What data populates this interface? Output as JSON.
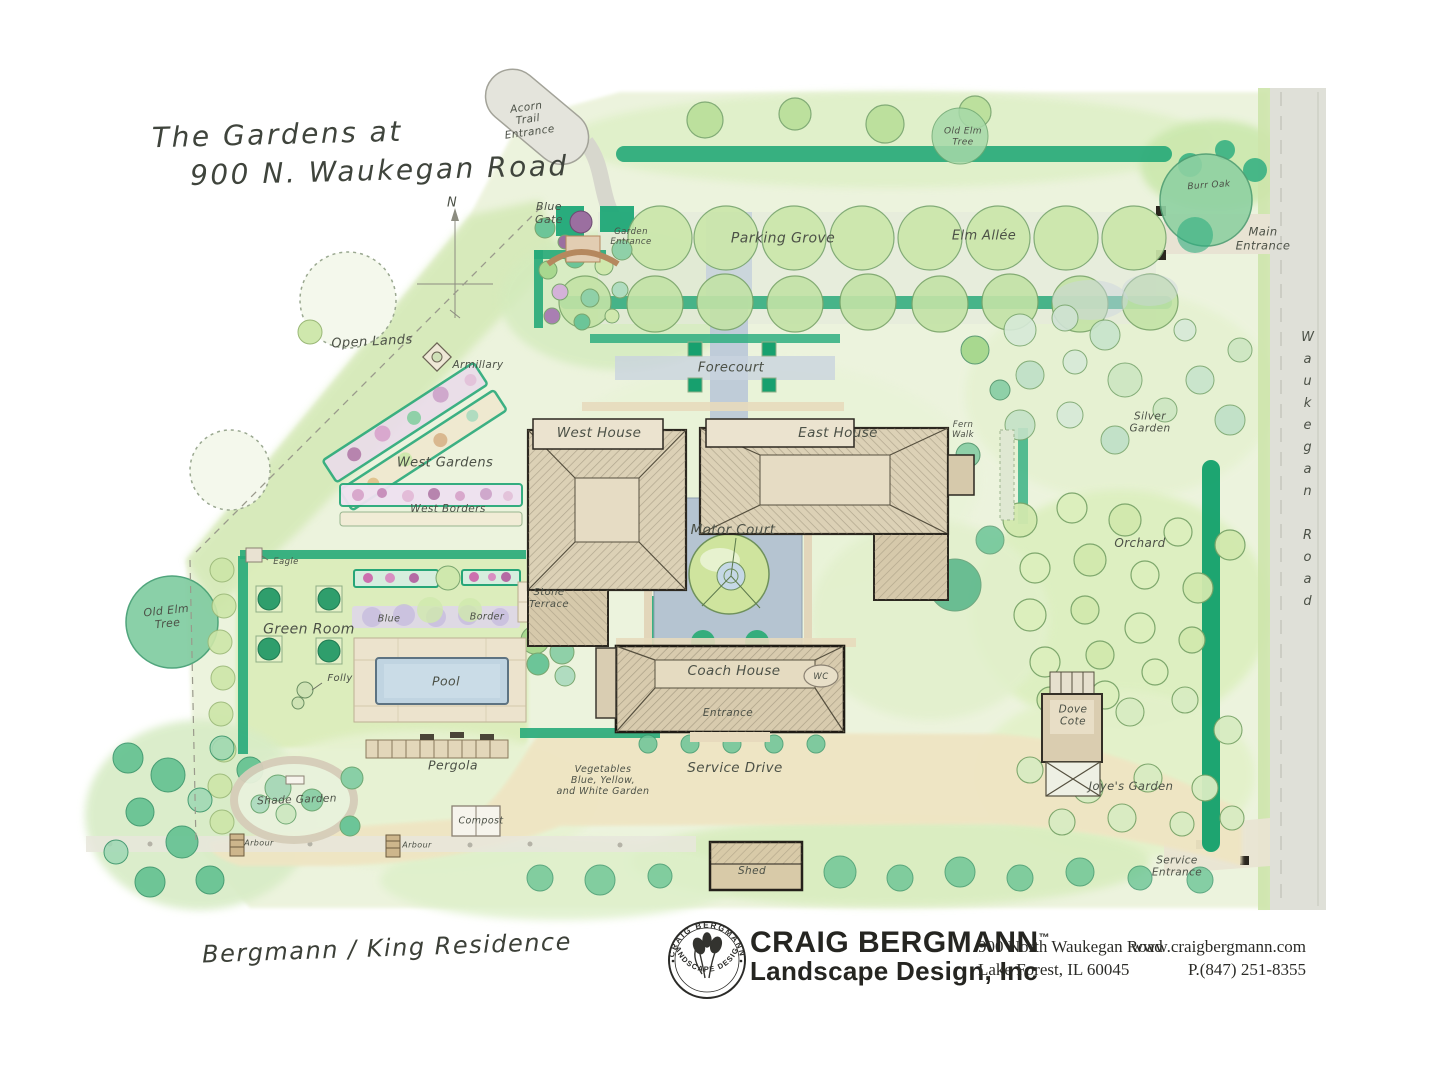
{
  "palette": {
    "paper": "#ffffff",
    "wash_light": "#ecf3dc",
    "wash_mid": "#d7ebc0",
    "hedge_teal": "#1ca273",
    "tree_green": "#cde8ad",
    "building_tan": "#dcd1b6",
    "path_beige": "#ece2c6",
    "court_blue": "#b4c3cf",
    "pool_blue": "#bcd2e0",
    "road_gray": "#dfe0d8",
    "label_ink": "#4c5147",
    "footer_ink": "#252521"
  },
  "title": {
    "line1": "The Gardens at",
    "line2": "900 N. Waukegan Road"
  },
  "compass": {
    "north": "N"
  },
  "map_labels": {
    "acorn_trail_entrance": "Acorn\nTrail\nEntrance",
    "blue_gate": "Blue\nGate",
    "garden_entrance": "Garden\nEntrance",
    "parking_grove": "Parking Grove",
    "elm_allee": "Elm Allée",
    "old_elm_tree_top": "Old Elm\nTree",
    "burr_oak": "Burr Oak",
    "main_entrance": "Main\nEntrance",
    "waukegan_road": "Waukegan Road",
    "open_lands": "Open Lands",
    "armillary": "Armillary",
    "forecourt": "Forecourt",
    "west_house": "West House",
    "east_house": "East House",
    "fern_walk": "Fern\nWalk",
    "silver_garden": "Silver\nGarden",
    "west_gardens": "West Gardens",
    "west_borders": "West Borders",
    "eagle": "Eagle",
    "motor_court": "Motor Court",
    "orchard": "Orchard",
    "stone_terrace": "Stone\nTerrace",
    "green_room": "Green Room",
    "old_elm_tree_left": "Old Elm\nTree",
    "blue_border_left": "Blue",
    "blue_border_right": "Border",
    "pool": "Pool",
    "folly": "Folly",
    "coach_house": "Coach House",
    "coach_house_entrance": "Entrance",
    "wc": "WC",
    "dove_cote": "Dove\nCote",
    "pergola": "Pergola",
    "vegetable_garden": "Vegetables\nBlue, Yellow,\nand White Garden",
    "service_drive": "Service Drive",
    "joyes_garden": "Joye's Garden",
    "shade_garden": "Shade Garden",
    "arbour_west": "Arbour",
    "arbour_mid": "Arbour",
    "compost": "Compost",
    "shed": "Shed",
    "service_entrance": "Service\nEntrance"
  },
  "signature": "Bergmann / King Residence",
  "footer": {
    "seal_top": "CRAIG BERGMANN",
    "seal_bottom": "LANDSCAPE DESIGN",
    "company": "CRAIG BERGMANN",
    "trademark": "™",
    "company_line2": "Landscape Design, Inc",
    "address": "900 North Waukegan Road\nLake Forest, IL 60045",
    "website": "www.craigbergmann.com",
    "phone": "P.(847) 251-8355"
  }
}
